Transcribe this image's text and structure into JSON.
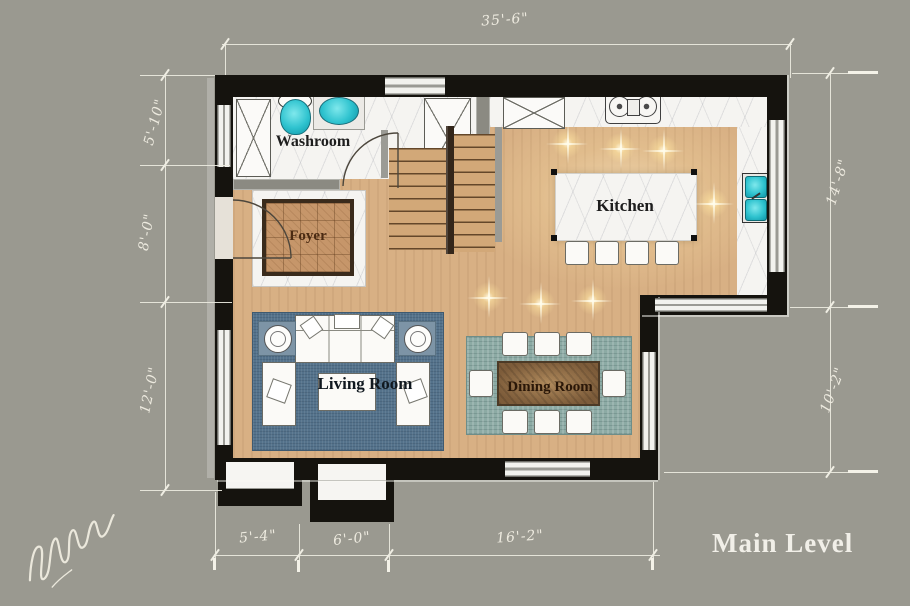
{
  "plan_title": "Main Level",
  "rooms": {
    "washroom": {
      "label": "Washroom"
    },
    "foyer": {
      "label": "Foyer"
    },
    "kitchen": {
      "label": "Kitchen"
    },
    "living_room": {
      "label": "Living Room"
    },
    "dining_room": {
      "label": "Dining Room"
    }
  },
  "dimensions": {
    "top_width": "35'-6\"",
    "left_upper": "5'-10\"",
    "left_middle": "8'-0\"",
    "left_lower": "12'-0\"",
    "right_upper": "14'-8\"",
    "right_lower": "10'-2\"",
    "bottom_left": "5'-4\"",
    "bottom_middle": "6'-0\"",
    "bottom_right": "16'-2\""
  },
  "colors": {
    "background": "#9a9990",
    "wall": "#15130e",
    "wood_floor": "#d8b084",
    "marble": "#f5f4f1",
    "fixture_teal": "#2fc3cf",
    "living_rug": "#54728b",
    "dining_rug": "#8caaa4",
    "dining_table": "#7d5c3a",
    "dimension_ink": "#edeadf"
  },
  "icons": {
    "signature": "handwritten-artist-signature",
    "sparkle": "ceiling-light-sparkle"
  }
}
